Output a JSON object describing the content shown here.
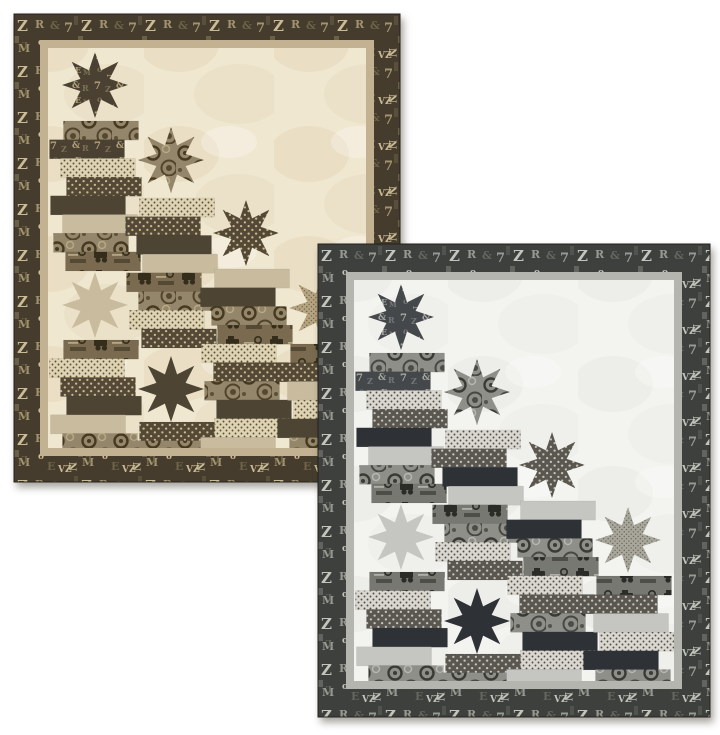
{
  "page": {
    "background_color": "#ffffff"
  },
  "canvas": {
    "width": 720,
    "height": 735
  },
  "fabric_glyphs": [
    "Z",
    "R",
    "&",
    "7",
    "N",
    "M",
    "o",
    "E",
    "L",
    "V"
  ],
  "star": {
    "size": 66,
    "inner_ratio": 0.24
  },
  "brick": {
    "width": 75,
    "height": 18.7,
    "offsets": [
      6,
      -8,
      3,
      9,
      -7,
      5,
      -4,
      8
    ]
  },
  "column_centers_x": [
    47,
    123,
    198,
    274
  ],
  "columns": [
    {
      "id": "column-1",
      "elements": [
        {
          "type": "star",
          "fabric": "letters",
          "y": 4
        },
        {
          "type": "stack",
          "y": 73,
          "bricks": [
            "gears",
            "letters",
            "dot-light",
            "dot-dark",
            "plain-dark",
            "plain-light",
            "gears",
            "trucks"
          ]
        },
        {
          "type": "star",
          "fabric": "plain-light",
          "y": 224
        },
        {
          "type": "stack",
          "y": 292,
          "bricks": [
            "trucks",
            "dot-light",
            "dot-dark",
            "plain-dark",
            "plain-light",
            "gears"
          ]
        }
      ]
    },
    {
      "id": "column-2",
      "elements": [
        {
          "type": "star",
          "fabric": "gears",
          "y": 79
        },
        {
          "type": "stack",
          "y": 150,
          "bricks": [
            "dot-light",
            "dot-dark",
            "plain-dark",
            "plain-light",
            "trucks",
            "gears",
            "dot-light",
            "dot-dark"
          ]
        },
        {
          "type": "star",
          "fabric": "plain-dark",
          "y": 308
        },
        {
          "type": "stack",
          "y": 374,
          "bricks": [
            "dot-dark",
            "gears"
          ]
        }
      ]
    },
    {
      "id": "column-3",
      "elements": [
        {
          "type": "star",
          "fabric": "dot-dark",
          "y": 152
        },
        {
          "type": "stack",
          "y": 221,
          "bricks": [
            "plain-light",
            "plain-dark",
            "gears",
            "trucks",
            "dot-light",
            "dot-dark",
            "gears",
            "plain-dark",
            "dot-light",
            "plain-light"
          ]
        }
      ]
    },
    {
      "id": "column-4",
      "elements": [
        {
          "type": "star",
          "fabric": "dot-tan",
          "y": 227
        },
        {
          "type": "stack",
          "y": 296,
          "bricks": [
            "trucks",
            "dot-dark",
            "plain-light",
            "dot-light",
            "plain-dark",
            "gears"
          ]
        }
      ]
    }
  ],
  "quilts": [
    {
      "id": "back-quilt",
      "colorway": "cream-and-brown",
      "x": 14,
      "y": 14,
      "width": 386,
      "height": 468,
      "border_width": 26,
      "strip_width": 8,
      "palette": {
        "background": "#f0e7d1",
        "background_shade": "#e3d7ba",
        "strip": "#c2b292",
        "border_bg": "#453c2d",
        "glyph1": "#a2946e",
        "glyph2": "#cbbb94",
        "glyph3": "#6e6147",
        "letters_bg": "#4a4132",
        "letters_glyph": "#b1a277",
        "letters_dim": "#7d7052",
        "gears_bg": "#93866a",
        "gears_dark": "#45391f",
        "gears_mid": "#c0b28c",
        "trucks_bg": "#7a6b50",
        "trucks_dark": "#352d1b",
        "trucks_light": "#bcad87",
        "dotlight_bg": "#ded3b3",
        "dotlight_dot": "#5c5037",
        "dotdark_bg": "#544936",
        "dotdark_dot": "#c8bb93",
        "plain_light": "#c9bc9e",
        "plain_dark": "#4e4434",
        "dottan_bg": "#b6a582",
        "dottan_dot": "#57492e"
      }
    },
    {
      "id": "front-quilt",
      "colorway": "gray-and-black",
      "x": 318,
      "y": 244,
      "width": 392,
      "height": 473,
      "border_width": 28,
      "strip_width": 8,
      "palette": {
        "background": "#f3f3f0",
        "background_shade": "#e7e7e2",
        "strip": "#b3b5ae",
        "border_bg": "#3d403d",
        "glyph1": "#989b93",
        "glyph2": "#c2c5bc",
        "glyph3": "#64675f",
        "letters_bg": "#45484a",
        "letters_glyph": "#a5a8a3",
        "letters_dim": "#74777a",
        "gears_bg": "#8f8f8a",
        "gears_dark": "#3b3b36",
        "gears_mid": "#c0c0ba",
        "trucks_bg": "#787872",
        "trucks_dark": "#2b2b27",
        "trucks_light": "#b5b5ae",
        "dotlight_bg": "#d9d7d0",
        "dotlight_dot": "#504e45",
        "dotdark_bg": "#59574f",
        "dotdark_dot": "#c7c5bb",
        "plain_light": "#c5c5c1",
        "plain_dark": "#2e3236",
        "dottan_bg": "#a9a79b",
        "dottan_dot": "#4f4d45"
      }
    }
  ],
  "shadow": {
    "css": "drop-shadow(3px 5px 4px rgba(60,54,42,0.45))"
  }
}
